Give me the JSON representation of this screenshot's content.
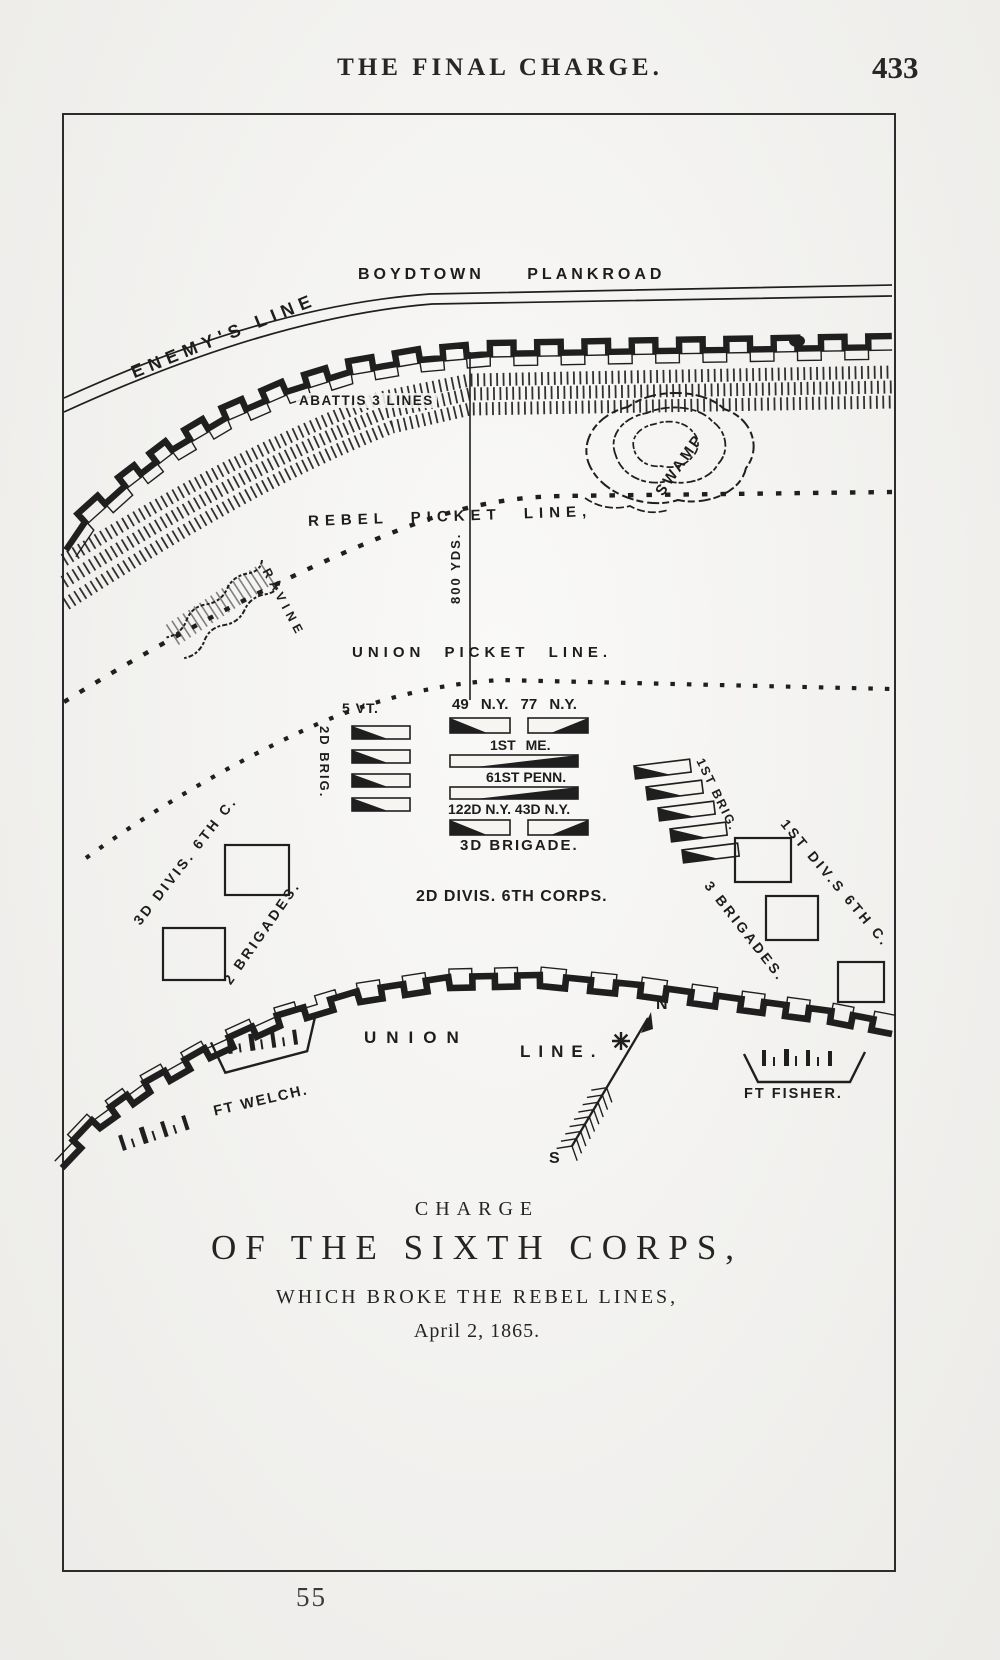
{
  "page": {
    "header": "THE FINAL CHARGE.",
    "page_number": "433",
    "plate_number": "55"
  },
  "map": {
    "road": "BOYDTOWN PLANKROAD",
    "enemy_line": "ENEMY'S LINE",
    "abattis": "ABATTIS 3 LINES",
    "swamp": "SWAMP",
    "rebel_picket": "REBEL PICKET LINE,",
    "distance": "800 YDS.",
    "ravine": "RAVINE",
    "union_picket": "UNION PICKET LINE.",
    "union_line_word1": "UNION",
    "union_line_word2": "LINE.",
    "fort_welch": "FT WELCH.",
    "fort_fisher": "FT FISHER.",
    "compass_north": "N",
    "compass_south": "S",
    "units": {
      "left": {
        "regiment": "5 VT.",
        "brigade": "2D BRIG."
      },
      "center": {
        "row1": "49 N.Y. 77 N.Y.",
        "row2": "1ST ME.",
        "row3": "61ST PENN.",
        "row4": "122D N.Y. 43D N.Y.",
        "row5": "3D BRIGADE.",
        "division": "2D DIVIS. 6TH CORPS."
      },
      "right": {
        "brigade": "1ST BRIG.",
        "division": "1ST DIV.S 6TH C.",
        "strength": "3 BRIGADES."
      },
      "far_left": {
        "division": "3D DIVIS. 6TH C.",
        "strength": "2 BRIGADES."
      }
    },
    "caption": {
      "line1": "CHARGE",
      "line2": "OF THE SIXTH CORPS,",
      "line3": "WHICH BROKE THE REBEL LINES,",
      "line4": "April 2, 1865."
    }
  }
}
